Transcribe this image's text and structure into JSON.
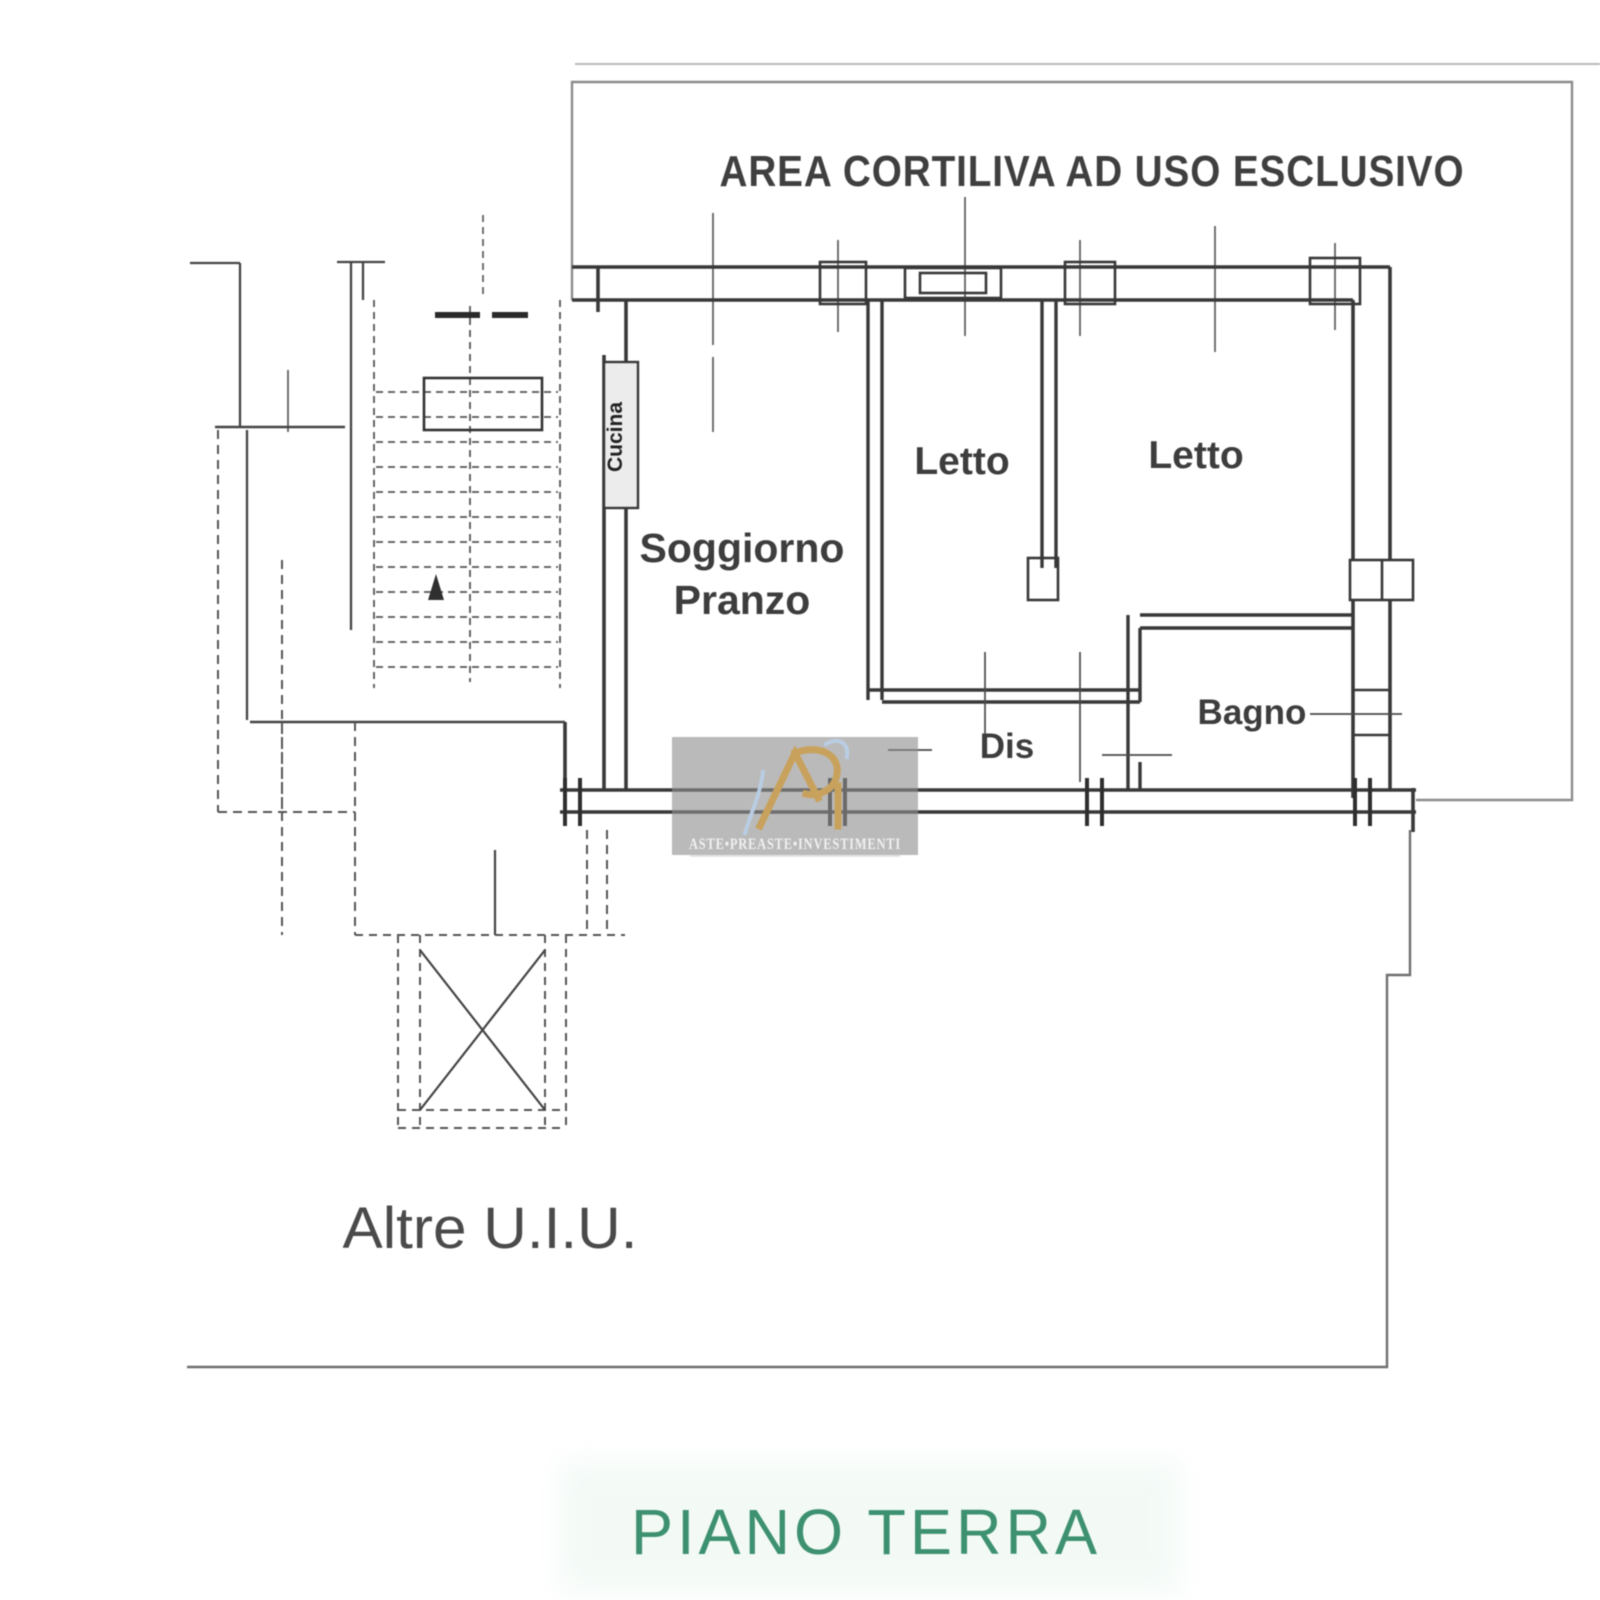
{
  "plan": {
    "title": "AREA CORTILIVA AD USO ESCLUSIVO",
    "floor_label": "PIANO TERRA",
    "other_units_label": "Altre U.I.U.",
    "rooms": {
      "living_line1": "Soggiorno",
      "living_line2": "Pranzo",
      "bedroom_left": "Letto",
      "bedroom_right": "Letto",
      "hallway": "Dis",
      "bathroom": "Bagno",
      "kitchen": "Cucina"
    }
  },
  "watermark": {
    "brand_text": "ASTE•PREASTE•INVESTIMENTI",
    "logo_icon": "api-gold-monogram"
  },
  "colors": {
    "plan_line": "#383838",
    "thin_line": "#8c8c8c",
    "floor_label_green": "#3d9170",
    "watermark_panel": "#909090",
    "watermark_gold": "#c8a25c",
    "watermark_blue": "#b9cfe6"
  }
}
